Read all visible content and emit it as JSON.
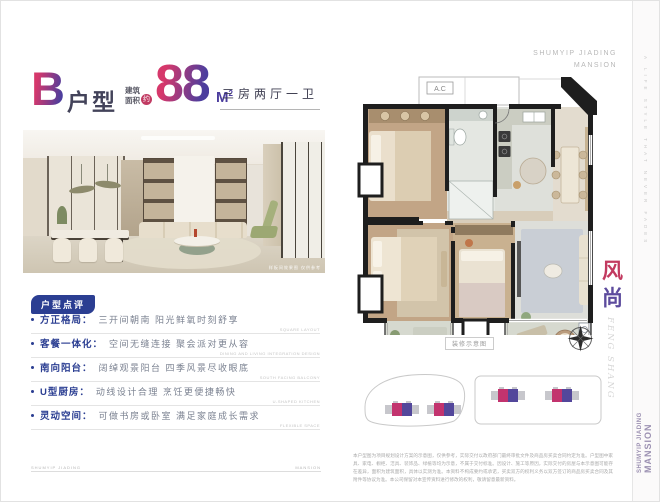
{
  "brand": {
    "top_line1": "SHUMYIP JIADING",
    "top_line2": "MANSION",
    "edge_tagline": "A LIFE STYLE THAT NEVER FADES",
    "side_line1": "SHUMYIP JIADING",
    "side_line2": "MANSION"
  },
  "header": {
    "unit_letter": "B",
    "unit_word": "户型",
    "area_label_1": "建筑",
    "area_label_2": "面积",
    "area_approx": "约",
    "area_value": "88",
    "area_unit": "M",
    "area_sup": "2",
    "rooms": "三房两厅一卫"
  },
  "photo": {
    "caption": "样板间效果图 仅供参考"
  },
  "review": {
    "tag": "户型点评",
    "items": [
      {
        "label": "方正格局：",
        "desc": "三开间朝南 阳光鲜氧时刻舒享",
        "en": "SQUARE LAYOUT"
      },
      {
        "label": "客餐一体化：",
        "desc": "空间无缝连接 聚会派对更从容",
        "en": "DINING AND LIVING INTEGRATION DESIGN"
      },
      {
        "label": "南向阳台：",
        "desc": "阔绰观景阳台 四季风景尽收眼底",
        "en": "SOUTH FACING BALCONY"
      },
      {
        "label": "U型厨房：",
        "desc": "动线设计合理 烹饪更便捷畅快",
        "en": "U-SHAPED KITCHEN"
      },
      {
        "label": "灵动空间：",
        "desc": "可做书房或卧室 满足家庭成长需求",
        "en": "FLEXIBLE SPACE"
      }
    ]
  },
  "floorplan": {
    "ac_label": "A.C",
    "caption": "装修示意图"
  },
  "sidebar": {
    "vertical_cn_1": "风",
    "vertical_cn_2": "尚",
    "vertical_en": "FENG SHANG"
  },
  "footer": {
    "rule_left": "SHUMYIP JIADING",
    "rule_right": "MANSION",
    "disclaimer": "本户型图为项目规划设计方案的示意图，仅供参考，实际交付以政府部门最终审批文件及商品房买卖合同约定为准。户型图中家具、家电、橱柜、洁具、装饰品、绿植等均为示意，不属于交付标准。因设计、施工等原因，实际交付的房屋与本示意图可能存在差异，面积为建筑面积，具体以实测为准。本资料不构成要约或承诺，买卖双方的权利义务以双方签订的商品房买卖合同及其附件等协议为准。本公司保留对本宣传资料进行修改的权利，敬请留意最新资料。"
  },
  "colors": {
    "accent_pink": "#C13A62",
    "accent_purple": "#5C4B9D",
    "accent_blue": "#2B3E92"
  }
}
